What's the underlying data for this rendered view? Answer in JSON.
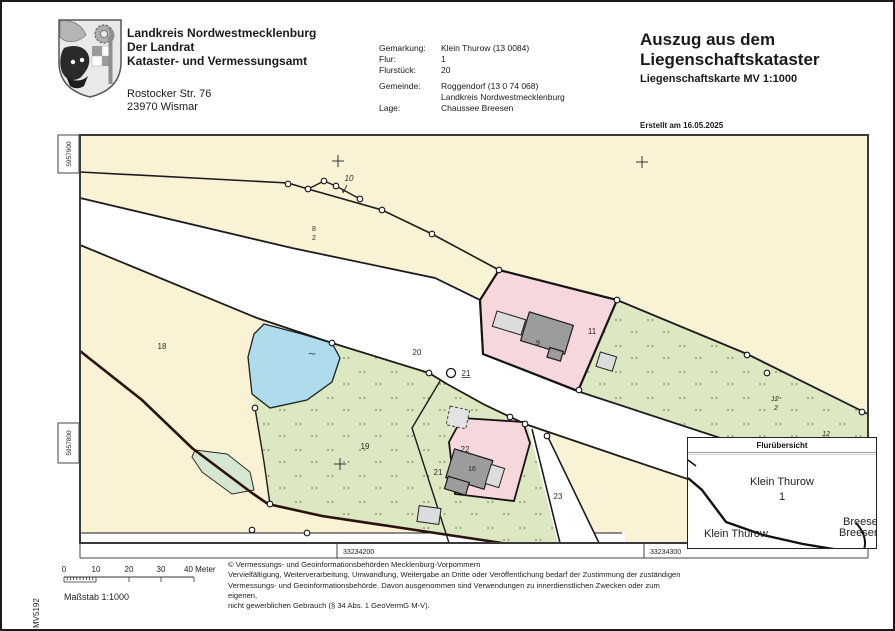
{
  "header": {
    "office": {
      "line1": "Landkreis Nordwestmecklenburg",
      "line2": "Der Landrat",
      "line3": "Kataster- und Vermessungsamt",
      "address1": "Rostocker Str. 76",
      "address2": "23970 Wismar"
    },
    "info": {
      "gemarkung_label": "Gemarkung:",
      "gemarkung": "Klein Thurow (13 0084)",
      "flur_label": "Flur:",
      "flur": "1",
      "flurstueck_label": "Flurstück:",
      "flurstueck": "20",
      "gemeinde_label": "Gemeinde:",
      "gemeinde1": "Roggendorf (13 0 74 068)",
      "gemeinde2": "Landkreis Nordwestmecklenburg",
      "lage_label": "Lage:",
      "lage": "Chaussee Breesen"
    },
    "title": {
      "line1": "Auszug aus dem",
      "line2": "Liegenschaftskataster",
      "subtitle": "Liegenschaftskarte MV 1:1000",
      "created": "Erstellt am 16.05.2025"
    }
  },
  "map": {
    "edge": {
      "north_top": "5957900",
      "north_bottom": "5957800",
      "east_left": "33234200",
      "east_right": "33234300",
      "sheet": "MV5192"
    },
    "water_symbol": "~",
    "parcels": {
      "p10": "10",
      "p8_top": "8",
      "p8_bot": "2",
      "p18": "18",
      "p20": "20",
      "p21_point": "21",
      "p19": "19",
      "p21": "21",
      "p22": "22",
      "p16": "16",
      "p9": "9",
      "p11": "11",
      "p23": "23",
      "p12_top": "12",
      "p12_bot": "2",
      "p12_edge": "12"
    },
    "colors": {
      "beige": "#FAF2D4",
      "road": "#FFFFFF",
      "grass_green": "#DCE8C2",
      "pond_blue": "#AFDCEC",
      "building_area_pink": "#F6D8DC",
      "building_dark": "#9C9C9C",
      "building_light": "#DCDCDC",
      "district_boundary": "#2B120E"
    }
  },
  "inset": {
    "title": "Flurübersicht",
    "area_name": "Klein Thurow",
    "area_number": "1",
    "neighbor_left": "Klein Thurow",
    "neighbor_right_1": "Breesen",
    "neighbor_right_2": "Breesen"
  },
  "scalebar": {
    "labels": [
      "0",
      "10",
      "20",
      "30"
    ],
    "end_label": "40 Meter",
    "caption": "Maßstab 1:1000"
  },
  "footer": {
    "lines": [
      "© Vermessungs- und Geoinformationsbehörden Mecklenburg-Vorpommern",
      "Vervielfältigung, Weiterverarbeitung, Umwandlung, Weitergabe an Dritte oder Veröffentlichung bedarf der Zustimmung der zuständigen",
      "Vermessungs- und Geoinformationsbehörde. Davon ausgenommen sind Verwendungen zu innerdienstlichen Zwecken oder zum eigenen,",
      "nicht gewerblichen Gebrauch (§ 34 Abs. 1 GeoVermG M-V)."
    ]
  }
}
